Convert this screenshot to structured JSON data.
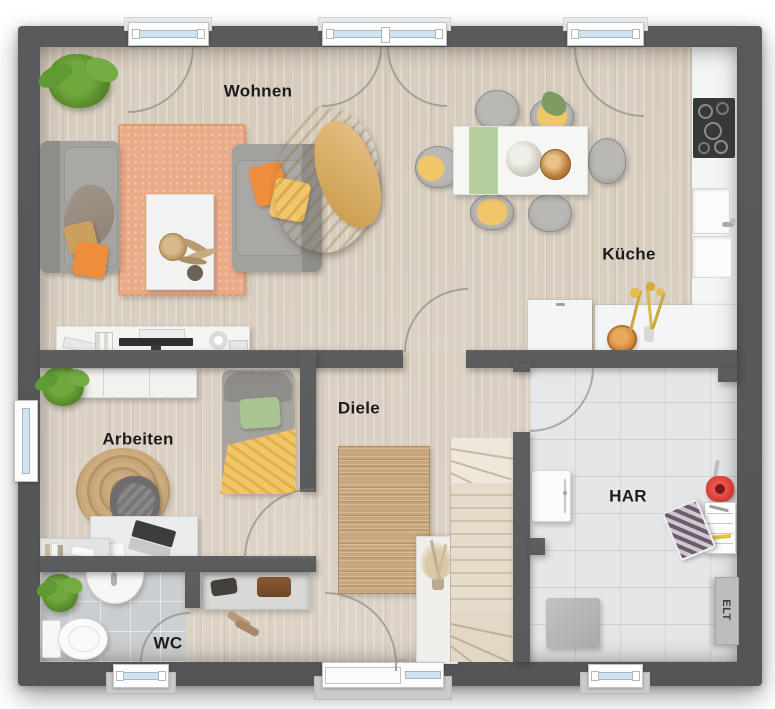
{
  "floorplan": {
    "labels": {
      "wohnen": "Wohnen",
      "kueche": "Küche",
      "arbeiten": "Arbeiten",
      "diele": "Diele",
      "wc": "WC",
      "har": "HAR",
      "elt": "ELT"
    },
    "colors": {
      "wall": "#595a5c",
      "wood_floor": "#d9cfc2",
      "wc_tile": "#cbced0",
      "har_tile": "#e5e6e8",
      "counter": "#f4f5f6",
      "rug_orange": "#ecab88",
      "rug_jute": "#c7a679",
      "sofa_gray": "#a3a19e",
      "accent_orange": "#ee8d3c",
      "accent_yellow": "#f0c668",
      "accent_camel": "#d2a058",
      "accent_green": "#a9c491",
      "runner_green": "#b5cf9e",
      "plant_green": "#6fa93e",
      "window_glass": "#cfe4f0",
      "stair_wood": "#e6dccb",
      "label_text": "#1c1c1c"
    }
  }
}
